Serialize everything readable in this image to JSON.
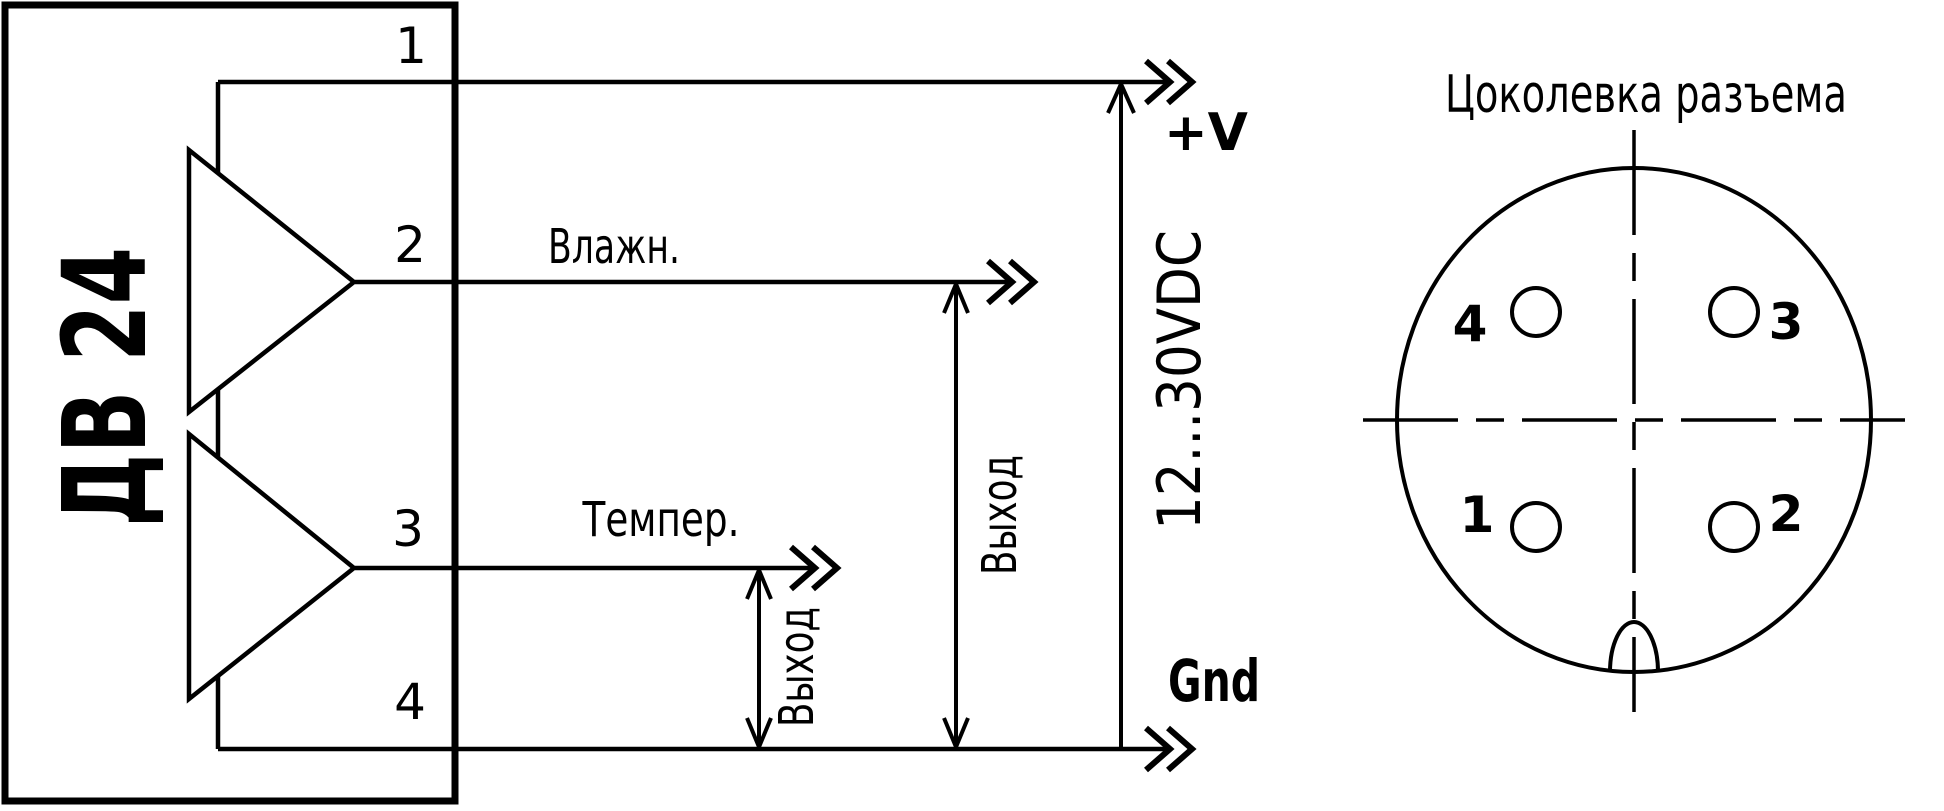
{
  "colors": {
    "ink": "#000000",
    "paper": "#ffffff"
  },
  "schematic": {
    "device_label": "ДВ 24",
    "pin1": "1",
    "pin2": "2",
    "pin3": "3",
    "pin4": "4",
    "wire2_label": "Влажн.",
    "wire3_label": "Темпер.",
    "output2_label": "Выход",
    "output3_label": "Выход",
    "supply_range": "12...30VDC",
    "supply_plus": "+V",
    "supply_gnd": "Gnd"
  },
  "connector": {
    "title": "Цоколевка разъема",
    "pin_top_left": "4",
    "pin_top_right": "3",
    "pin_bottom_left": "1",
    "pin_bottom_right": "2"
  }
}
